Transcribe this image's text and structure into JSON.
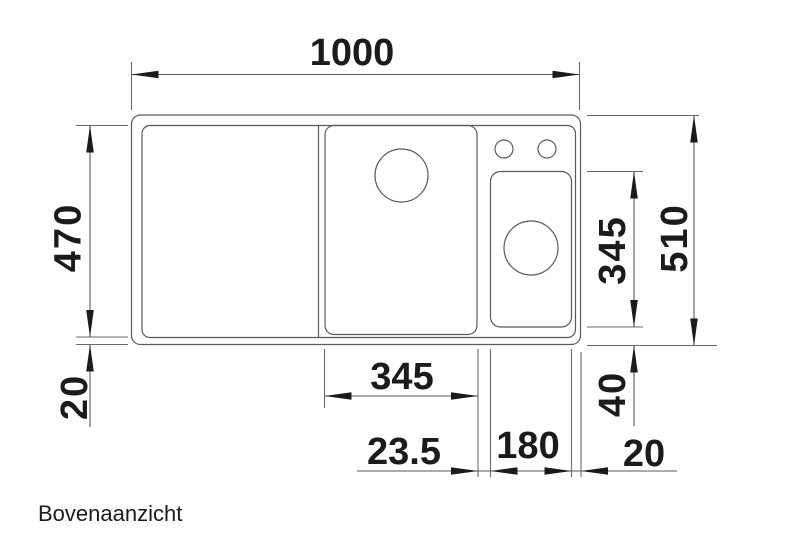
{
  "title": "Bovenaanzicht",
  "colors": {
    "background": "#ffffff",
    "line": "#5a5a5a",
    "ink": "#1b1b1b"
  },
  "dimensions": {
    "overall_width": "1000",
    "overall_depth": "510",
    "inner_depth": "470",
    "bottom_rim": "20",
    "main_bowl_width": "345",
    "side_bowl_depth": "345",
    "side_bowl_bottom_offset": "40",
    "bowl_gap": "23.5",
    "side_bowl_width": "180",
    "right_rim": "20"
  }
}
